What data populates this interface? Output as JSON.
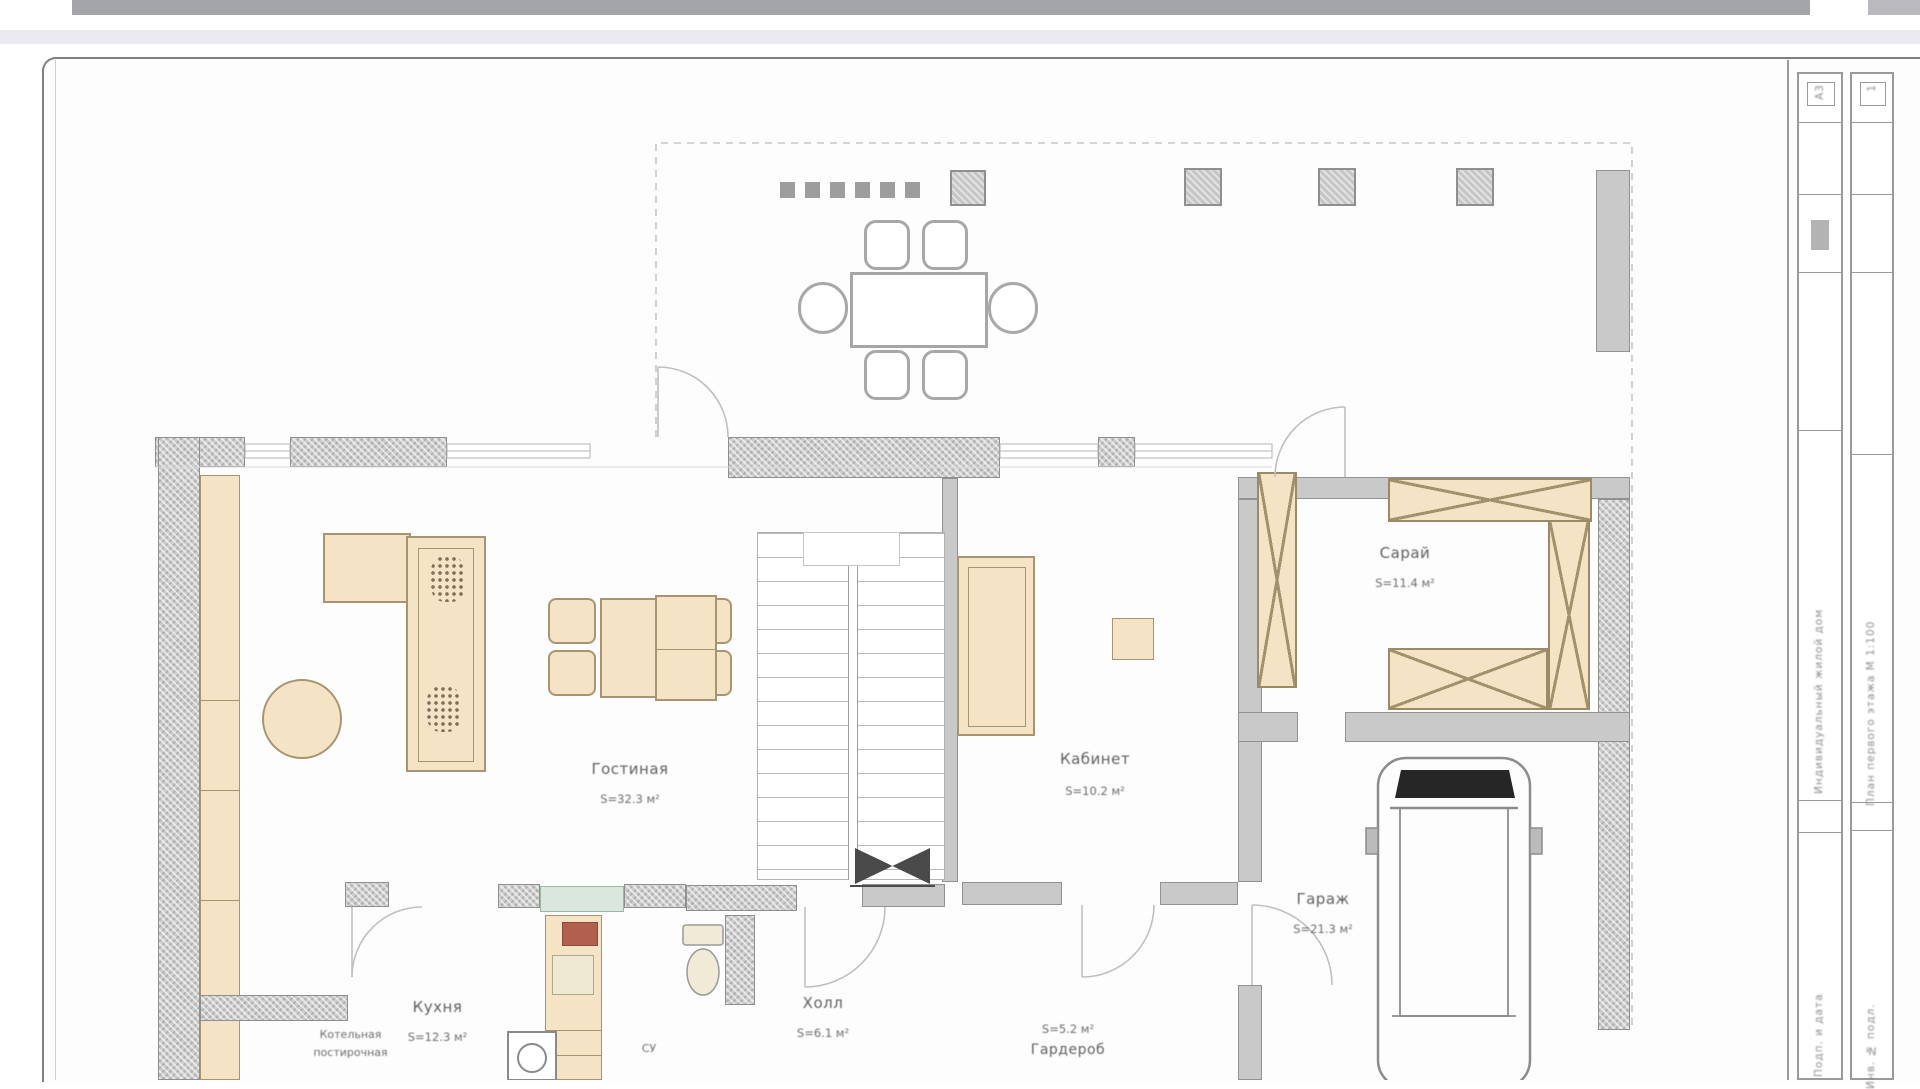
{
  "chrome": {
    "topbar_color": "#a4a4ab",
    "band_color": "#ebebef"
  },
  "sheet": {
    "border_color": "#7f7f7f",
    "paper_color": "#fdfdfd"
  },
  "plan": {
    "rooms": [
      {
        "name": "Гостиная",
        "area": "S=32.3 м²"
      },
      {
        "name": "Кабинет",
        "area": "S=10.2 м²"
      },
      {
        "name": "Сарай",
        "area": "S=11.4 м²"
      },
      {
        "name": "Гараж",
        "area": "S=21.3 м²"
      },
      {
        "name": "Кухня",
        "area": "S=12.3 м²"
      },
      {
        "name": "Холл",
        "area": "S=6.1 м²"
      },
      {
        "name": "Гардероб",
        "area": "S=5.2 м²"
      },
      {
        "name": "Котельная",
        "area": "постирочная"
      }
    ],
    "small_labels": {
      "wc": "СУ"
    },
    "colors": {
      "wall": "#c9c9c9",
      "furniture": "#f4e3c4",
      "stove": "#b2604e",
      "window_sill": "#d9e7de",
      "line": "#c0c0c0"
    }
  },
  "titleblock": {
    "col1_format": "А3",
    "col2_sheet": "1",
    "col1_main": "Индивидуальный жилой дом",
    "col2_main": "План первого этажа М 1:100",
    "col1_bottom": "Подп. и дата",
    "col2_bottom": "Инв. № подл."
  }
}
